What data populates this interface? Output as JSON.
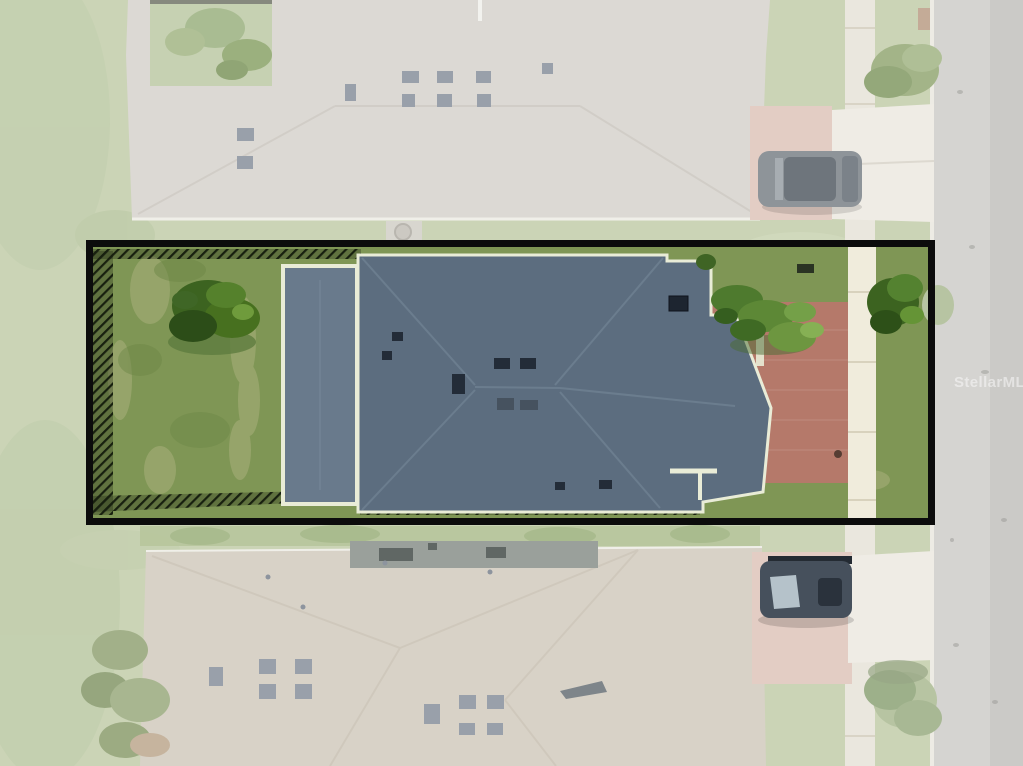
{
  "watermark": {
    "text": "StellarMLS",
    "color": "rgba(255,255,255,0.48)"
  },
  "palette": {
    "grass_faded": "#cbd4b6",
    "lawn": "#7f9655",
    "roof_main": "#5c6d7f",
    "roof_garage": "#697a8c",
    "trim": "#e9ecd7",
    "brick": "#b5796a",
    "brick_faded": "#e3cdc4",
    "street": "#d5d4d1",
    "street_dark": "#c6c5c2",
    "curb": "#edebe4",
    "sidewalk_faded": "#eae7de",
    "sidewalk": "#f0ecdc",
    "concrete": "#efece5",
    "roof_top_faded": "#dcd9d4",
    "roof_bottom_faded": "#d8d2c7",
    "lanai": "#9aa09b",
    "boundary": "#0c0c0c",
    "fence": "#18200f",
    "shrub": "#4e7a2e",
    "tree": "#3c6320",
    "tree_faded": "#b7c4a2",
    "hedge_faded": "#b7c59c",
    "suv": "#8e9499",
    "car": "#46505c",
    "vent_dark": "#232c38",
    "vent_faded": "#99a0aa"
  }
}
